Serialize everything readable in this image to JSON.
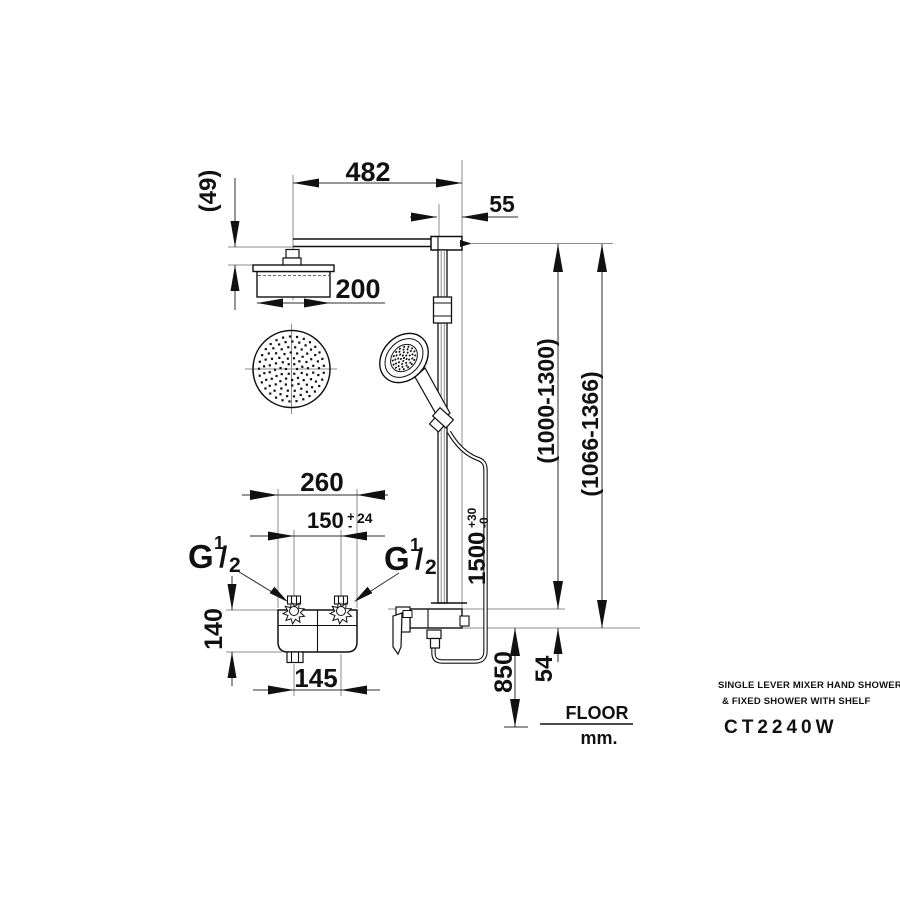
{
  "product": {
    "title_line1": "SINGLE LEVER MIXER HAND SHOWER",
    "title_line2": "& FIXED  SHOWER WITH SHELF",
    "model": "CT2240W"
  },
  "floor_note": {
    "floor": "FLOOR",
    "units": "mm."
  },
  "dims": {
    "arm_reach": "482",
    "rail_offset": "55",
    "head_drop": "(49)",
    "head_size": "200",
    "shelf_width": "260",
    "inlet_spacing": "150",
    "inlet_tol_plus": "+",
    "inlet_tol_minus": "-",
    "inlet_tol": "24",
    "thread_g": "G",
    "thread_num": "1",
    "thread_slash": "/",
    "thread_den": "2",
    "body_height": "140",
    "outlet_span": "145",
    "hose_height": "1500",
    "hose_tol_plus": "+30",
    "hose_tol_minus": "-0",
    "rail_range": "(1000-1300)",
    "overall_range": "(1066-1366)",
    "mixer_height": "850",
    "shelf_gap": "54"
  }
}
